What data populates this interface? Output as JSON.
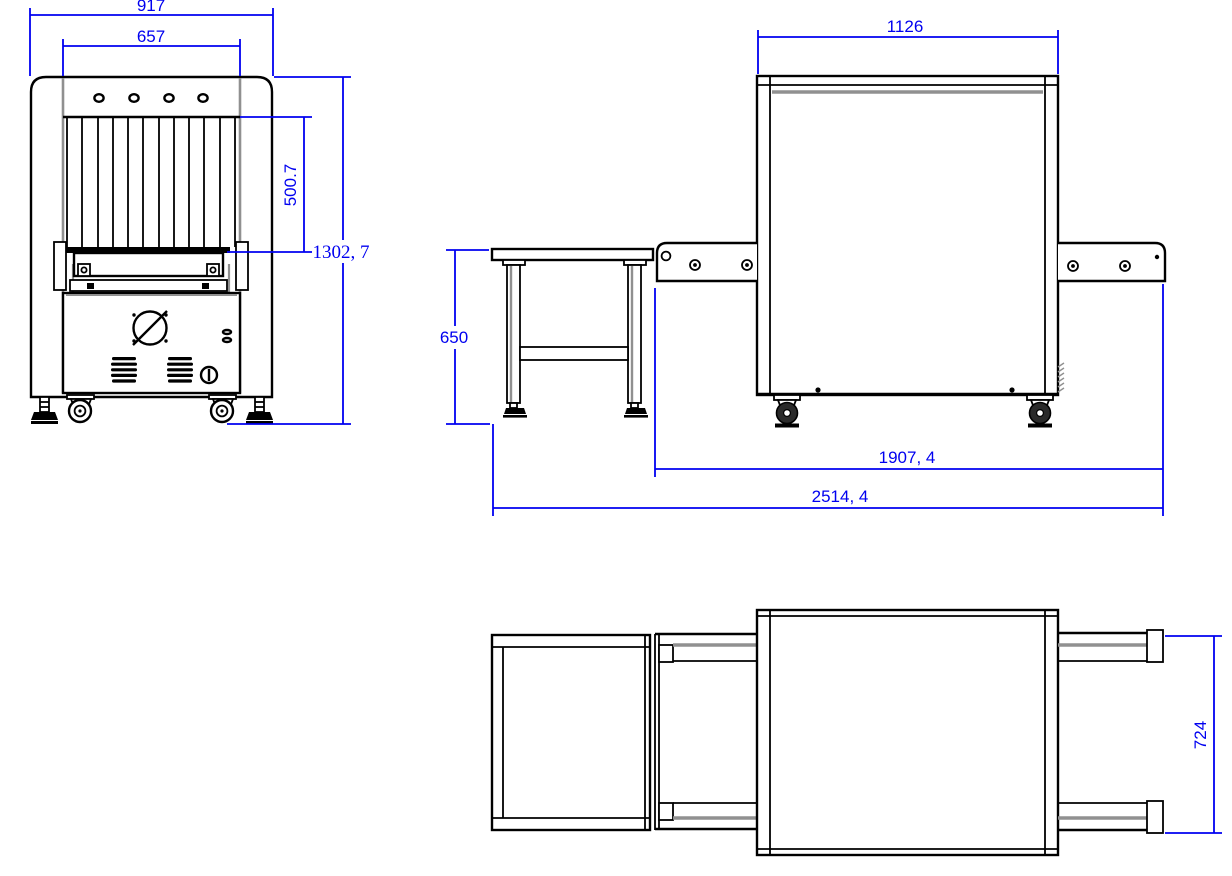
{
  "document": {
    "type": "technical-drawing",
    "subject": "X-ray baggage scanner three-view dimensional drawing",
    "background_color": "#ffffff",
    "line_color": "#000000",
    "shade_color": "#909090",
    "dimension_color": "#0000f0"
  },
  "views": {
    "front": {
      "name": "front-view",
      "dimensions": {
        "overall_width": "917",
        "tunnel_width": "657",
        "tunnel_height": "500.7",
        "overall_height": "1302, 7"
      }
    },
    "side": {
      "name": "side-view",
      "dimensions": {
        "body_length": "1126",
        "table_height": "650",
        "machine_length": "1907, 4",
        "overall_length": "2514, 4"
      }
    },
    "top": {
      "name": "top-view",
      "dimensions": {
        "overall_depth": "724"
      }
    }
  }
}
